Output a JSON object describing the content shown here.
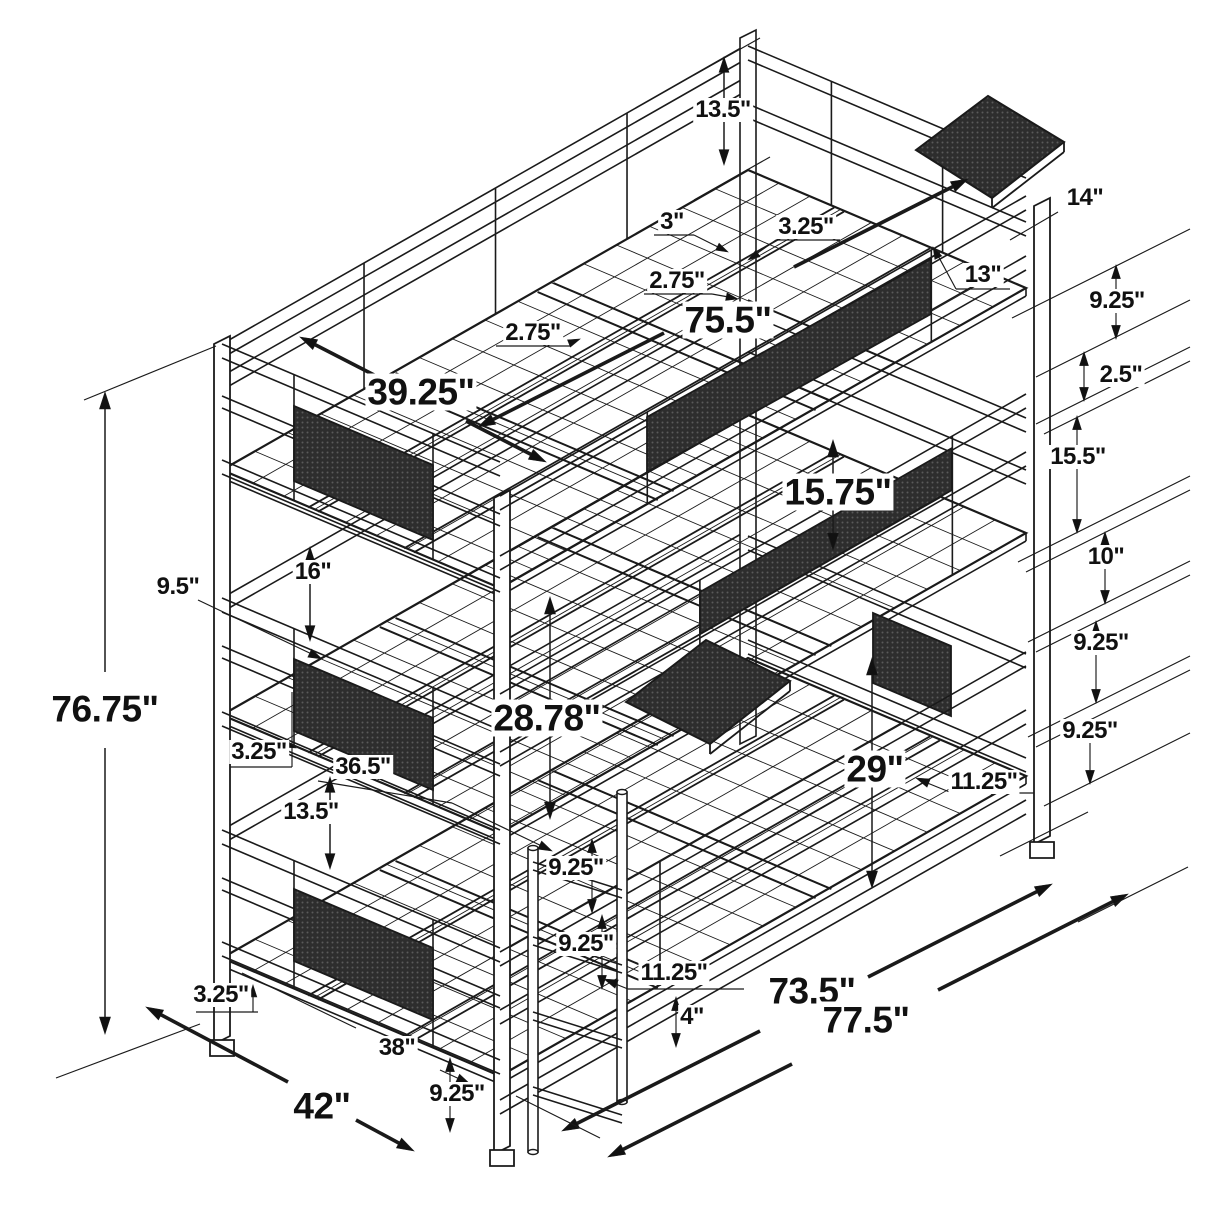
{
  "page": {
    "background": "#ffffff",
    "line_color": "#1a1a1a",
    "drawing_type": "isometric dimension line drawing",
    "subject": "metal triple twin bunk bed frame with ladder and clip-on trays",
    "unit": "inches"
  },
  "overall_dimensions": {
    "height": "76.75\"",
    "width": "42\"",
    "length": "77.5\"",
    "inner_length": "73.5\""
  },
  "labels": [
    {
      "text": "13.5\"",
      "x": 723,
      "y": 110,
      "size": "sm"
    },
    {
      "text": "3\"",
      "x": 672,
      "y": 222,
      "size": "sm"
    },
    {
      "text": "3.25\"",
      "x": 806,
      "y": 227,
      "size": "sm"
    },
    {
      "text": "2.75\"",
      "x": 677,
      "y": 281,
      "size": "sm"
    },
    {
      "text": "2.75\"",
      "x": 533,
      "y": 333,
      "size": "sm"
    },
    {
      "text": "14\"",
      "x": 1085,
      "y": 198,
      "size": "sm"
    },
    {
      "text": "13\"",
      "x": 983,
      "y": 275,
      "size": "sm"
    },
    {
      "text": "9.25\"",
      "x": 1117,
      "y": 301,
      "size": "sm"
    },
    {
      "text": "2.5\"",
      "x": 1121,
      "y": 375,
      "size": "sm"
    },
    {
      "text": "75.5\"",
      "x": 728,
      "y": 320,
      "size": "lg"
    },
    {
      "text": "39.25\"",
      "x": 421,
      "y": 392,
      "size": "lg"
    },
    {
      "text": "15.5\"",
      "x": 1078,
      "y": 457,
      "size": "sm"
    },
    {
      "text": "15.75\"",
      "x": 838,
      "y": 492,
      "size": "lg"
    },
    {
      "text": "10\"",
      "x": 1106,
      "y": 557,
      "size": "sm"
    },
    {
      "text": "16\"",
      "x": 313,
      "y": 572,
      "size": "sm"
    },
    {
      "text": "9.5\"",
      "x": 178,
      "y": 587,
      "size": "sm"
    },
    {
      "text": "9.25\"",
      "x": 1101,
      "y": 643,
      "size": "sm"
    },
    {
      "text": "28.78\"",
      "x": 547,
      "y": 718,
      "size": "lg"
    },
    {
      "text": "9.25\"",
      "x": 1090,
      "y": 731,
      "size": "sm"
    },
    {
      "text": "3.25\"",
      "x": 259,
      "y": 752,
      "size": "sm"
    },
    {
      "text": "36.5\"",
      "x": 363,
      "y": 767,
      "size": "sm"
    },
    {
      "text": "29\"",
      "x": 875,
      "y": 769,
      "size": "lg"
    },
    {
      "text": "11.25\"",
      "x": 984,
      "y": 782,
      "size": "sm"
    },
    {
      "text": "13.5\"",
      "x": 311,
      "y": 812,
      "size": "sm"
    },
    {
      "text": "76.75\"",
      "x": 105,
      "y": 709,
      "size": "lg"
    },
    {
      "text": "9.25\"",
      "x": 576,
      "y": 868,
      "size": "sm"
    },
    {
      "text": "9.25\"",
      "x": 586,
      "y": 944,
      "size": "sm"
    },
    {
      "text": "11.25\"",
      "x": 674,
      "y": 973,
      "size": "sm"
    },
    {
      "text": "4\"",
      "x": 692,
      "y": 1017,
      "size": "sm"
    },
    {
      "text": "73.5\"",
      "x": 812,
      "y": 991,
      "size": "lg"
    },
    {
      "text": "77.5\"",
      "x": 866,
      "y": 1020,
      "size": "lg"
    },
    {
      "text": "3.25\"",
      "x": 221,
      "y": 995,
      "size": "sm"
    },
    {
      "text": "38\"",
      "x": 397,
      "y": 1048,
      "size": "sm"
    },
    {
      "text": "42\"",
      "x": 322,
      "y": 1106,
      "size": "lg"
    },
    {
      "text": "9.25\"",
      "x": 457,
      "y": 1094,
      "size": "sm"
    }
  ]
}
